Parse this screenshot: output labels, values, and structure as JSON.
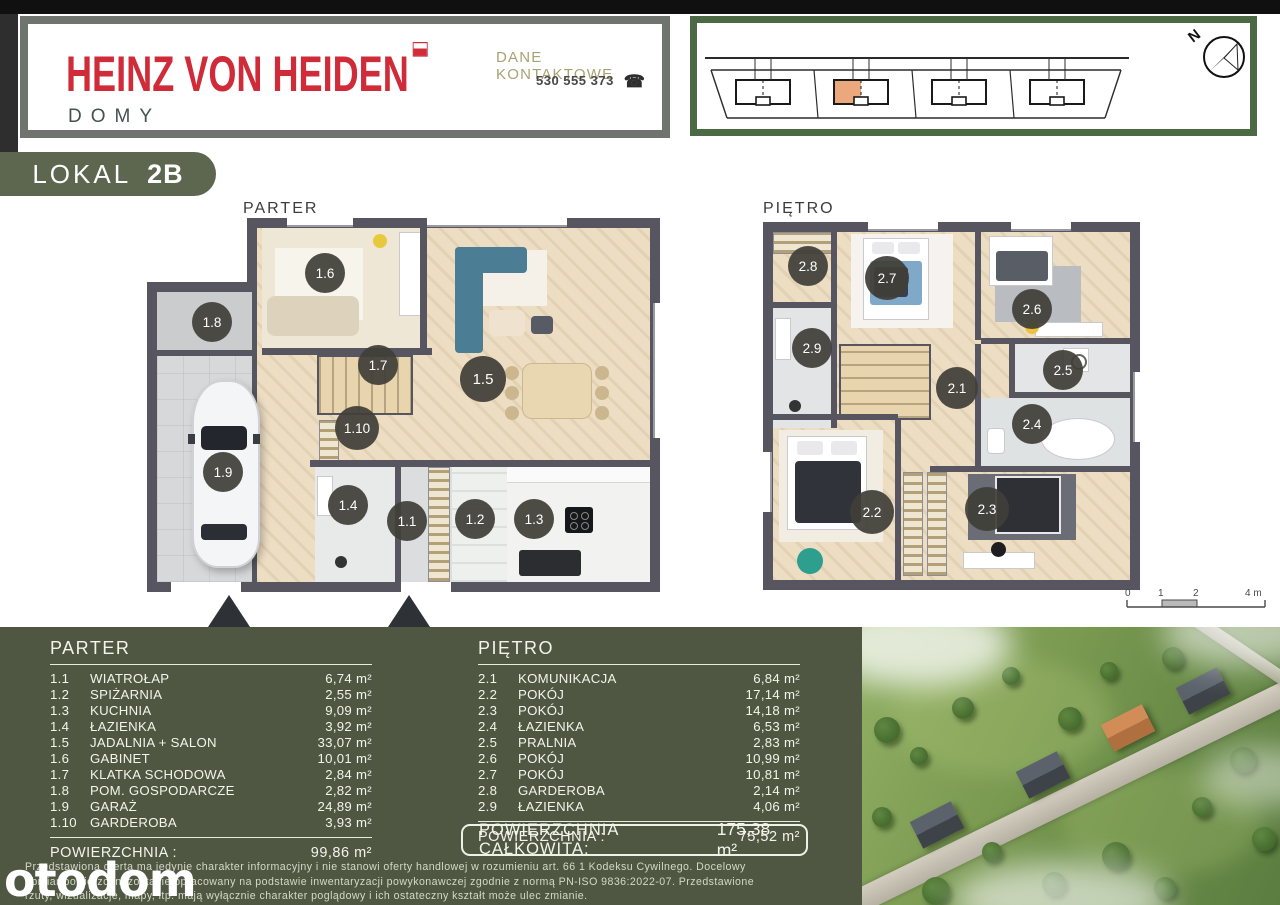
{
  "colors": {
    "panel_olive": "#4f5743",
    "badge_green": "#5d664f",
    "header_green_border": "#4b6a44",
    "header_gray_border": "#70746f",
    "brand_red": "#cf2b39",
    "highlight_orange": "#eaa87c",
    "plan_wall": "#57555f"
  },
  "header": {
    "brand_name": "HEINZ VON HEIDEN",
    "brand_sub": "DOMY",
    "contact_label": "DANE KONTAKTOWE",
    "contact_phone": "530 555 373",
    "compass": "N"
  },
  "unit": {
    "label": "LOKAL",
    "number": "2B"
  },
  "plans": {
    "parter_title": "PARTER",
    "pietro_title": "PIĘTRO",
    "parter_rooms": [
      "1.6",
      "1.8",
      "1.7",
      "1.5",
      "1.10",
      "1.9",
      "1.4",
      "1.1",
      "1.2",
      "1.3"
    ],
    "pietro_rooms": [
      "2.8",
      "2.7",
      "2.6",
      "2.9",
      "2.1",
      "2.5",
      "2.4",
      "2.2",
      "2.3"
    ],
    "scale_labels": [
      "0",
      "1",
      "2",
      "4 m"
    ]
  },
  "tables": {
    "parter": {
      "title": "PARTER",
      "rows": [
        {
          "id": "1.1",
          "name": "WIATROŁAP",
          "area": "6,74 m²"
        },
        {
          "id": "1.2",
          "name": "SPIŻARNIA",
          "area": "2,55 m²"
        },
        {
          "id": "1.3",
          "name": "KUCHNIA",
          "area": "9,09 m²"
        },
        {
          "id": "1.4",
          "name": "ŁAZIENKA",
          "area": "3,92 m²"
        },
        {
          "id": "1.5",
          "name": "JADALNIA + SALON",
          "area": "33,07 m²"
        },
        {
          "id": "1.6",
          "name": "GABINET",
          "area": "10,01 m²"
        },
        {
          "id": "1.7",
          "name": "KLATKA SCHODOWA",
          "area": "2,84 m²"
        },
        {
          "id": "1.8",
          "name": "POM. GOSPODARCZE",
          "area": "2,82 m²"
        },
        {
          "id": "1.9",
          "name": "GARAŻ",
          "area": "24,89 m²"
        },
        {
          "id": "1.10",
          "name": "GARDEROBA",
          "area": "3,93 m²"
        }
      ],
      "total_label": "POWIERZCHNIA :",
      "total_value": "99,86 m²"
    },
    "pietro": {
      "title": "PIĘTRO",
      "rows": [
        {
          "id": "2.1",
          "name": "KOMUNIKACJA",
          "area": "6,84 m²"
        },
        {
          "id": "2.2",
          "name": "POKÓJ",
          "area": "17,14 m²"
        },
        {
          "id": "2.3",
          "name": "POKÓJ",
          "area": "14,18 m²"
        },
        {
          "id": "2.4",
          "name": "ŁAZIENKA",
          "area": "6,53 m²"
        },
        {
          "id": "2.5",
          "name": "PRALNIA",
          "area": "2,83 m²"
        },
        {
          "id": "2.6",
          "name": "POKÓJ",
          "area": "10,99 m²"
        },
        {
          "id": "2.7",
          "name": "POKÓJ",
          "area": "10,81 m²"
        },
        {
          "id": "2.8",
          "name": "GARDEROBA",
          "area": "2,14 m²"
        },
        {
          "id": "2.9",
          "name": "ŁAZIENKA",
          "area": "4,06 m²"
        }
      ],
      "total_label": "POWIERZCHNIA :",
      "total_value": "75,52 m²"
    },
    "grand_total": {
      "label": "POWIERZCHNIA CAŁKOWITA:",
      "value": "175,38 m²"
    }
  },
  "footer": {
    "disclaimer": [
      "Przedstawiona oferta ma jedynie charakter informacyjny i nie stanowi oferty handlowej w rozumieniu art. 66 1 Kodeksu Cywilnego. Docelowy",
      "obmiar powierzchni zostanie opracowany na podstawie inwentaryzacji powykonawczej zgodnie z normą PN-ISO 9836:2022-07. Przedstawione",
      "rzuty, wizualizacje, mapy, itp. mają wyłącznie charakter poglądowy i ich ostateczny kształt może ulec zmianie."
    ],
    "watermark": "otodom"
  }
}
